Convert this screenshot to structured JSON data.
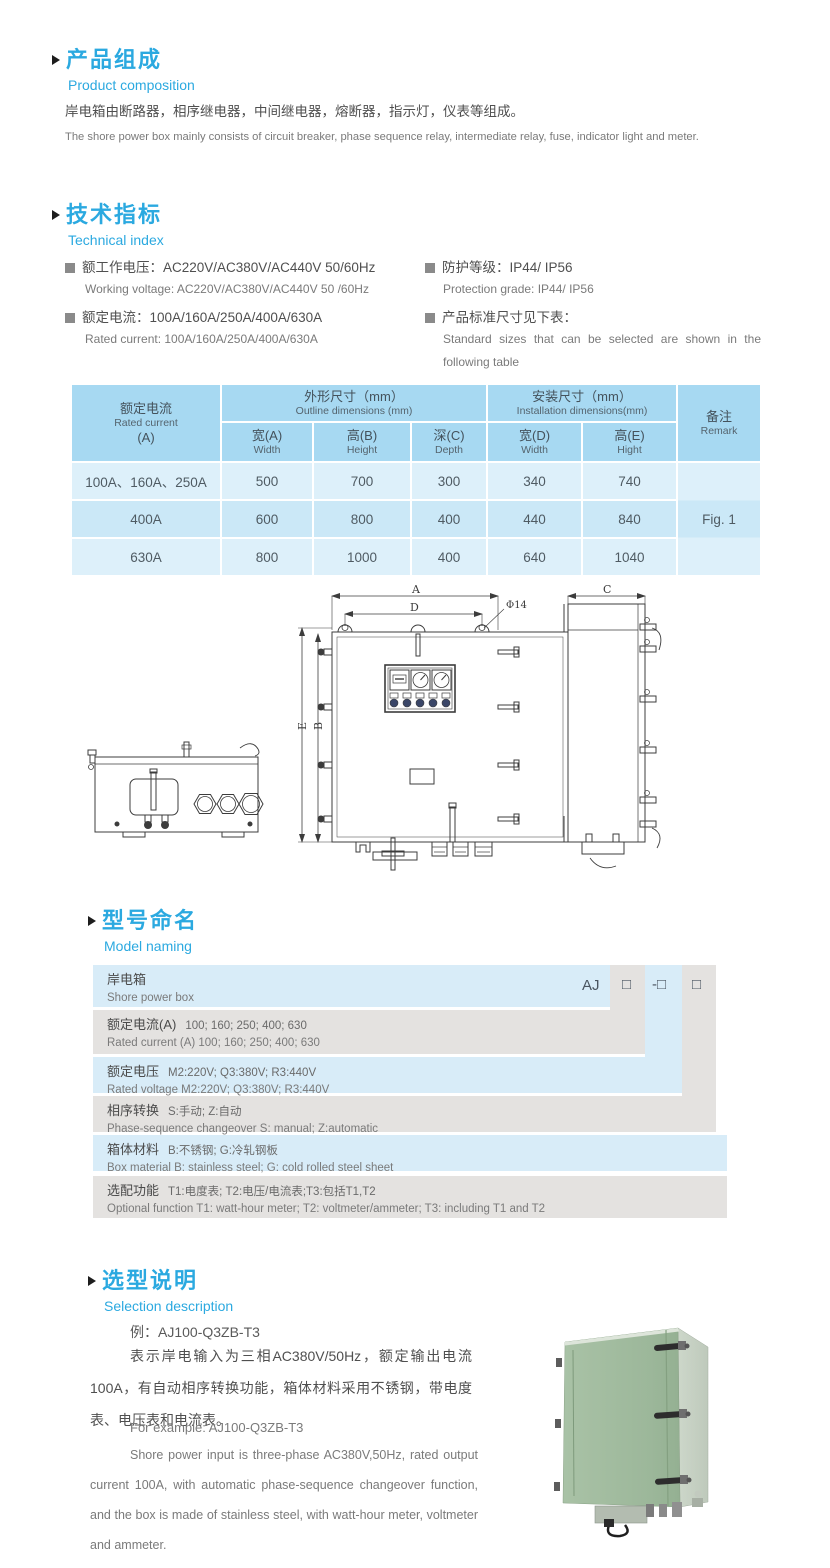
{
  "accent_color": "#2ba9e0",
  "product_composition": {
    "title_cn": "产品组成",
    "title_en": "Product  composition",
    "body_cn": "岸电箱由断路器，相序继电器，中间继电器，熔断器，指示灯，仪表等组成。",
    "body_en": "The shore power box mainly consists of circuit breaker, phase sequence relay, intermediate relay, fuse, indicator light and meter."
  },
  "technical_index": {
    "title_cn": "技术指标",
    "title_en": "Technical index",
    "specs_left": [
      {
        "cn": "额工作电压：AC220V/AC380V/AC440V  50/60Hz",
        "en": "Working voltage: AC220V/AC380V/AC440V 50 /60Hz"
      },
      {
        "cn": "额定电流：100A/160A/250A/400A/630A",
        "en": "Rated current: 100A/160A/250A/400A/630A"
      }
    ],
    "specs_right": [
      {
        "cn": "防护等级：IP44/ IP56",
        "en": "Protection grade: IP44/ IP56"
      },
      {
        "cn": "产品标准尺寸见下表：",
        "en": "Standard sizes that can be selected are shown in the following table"
      }
    ]
  },
  "dimensions_table": {
    "header": {
      "current_cn": "额定电流",
      "current_en": "Rated current",
      "current_unit": "(A)",
      "outline_cn": "外形尺寸（mm）",
      "outline_en": "Outline dimensions (mm)",
      "install_cn": "安装尺寸（mm）",
      "install_en": "Installation dimensions(mm)",
      "remark_cn": "备注",
      "remark_en": "Remark",
      "sub": [
        {
          "cn": "宽(A)",
          "en": "Width"
        },
        {
          "cn": "高(B)",
          "en": "Height"
        },
        {
          "cn": "深(C)",
          "en": "Depth"
        },
        {
          "cn": "宽(D)",
          "en": "Width"
        },
        {
          "cn": "高(E)",
          "en": "Hight"
        }
      ]
    },
    "rows": [
      {
        "current": "100A、160A、250A",
        "a": "500",
        "b": "700",
        "c": "300",
        "d": "340",
        "e": "740"
      },
      {
        "current": "400A",
        "a": "600",
        "b": "800",
        "c": "400",
        "d": "440",
        "e": "840"
      },
      {
        "current": "630A",
        "a": "800",
        "b": "1000",
        "c": "400",
        "d": "640",
        "e": "1040"
      }
    ],
    "remark_value": "Fig. 1"
  },
  "figure": {
    "labels": {
      "a": "A",
      "d": "D",
      "hole": "Φ14",
      "e": "E",
      "b": "B",
      "c": "C"
    }
  },
  "model_naming": {
    "title_cn": "型号命名",
    "title_en": "Model naming",
    "code": {
      "prefix": "AJ",
      "slot1": "□",
      "slot2": "-□",
      "slot3": "□"
    },
    "rows": [
      {
        "cn_label": "岸电箱",
        "en": "Shore power box"
      },
      {
        "cn_label": "额定电流(A)",
        "cn_value": "100; 160; 250; 400; 630",
        "en": "Rated current (A) 100; 160; 250; 400; 630"
      },
      {
        "cn_label": "额定电压",
        "cn_value": "M2:220V;  Q3:380V;  R3:440V",
        "en": "Rated voltage  M2:220V;  Q3:380V;  R3:440V"
      },
      {
        "cn_label": "相序转换",
        "cn_value": "S:手动; Z:自动",
        "en": "Phase-sequence changeover  S: manual;  Z:automatic"
      },
      {
        "cn_label": "箱体材料",
        "cn_value": "B:不锈钢;  G:冷轧钢板",
        "en": "Box material   B: stainless steel; G: cold rolled steel sheet"
      },
      {
        "cn_label": "选配功能",
        "cn_value": "T1:电度表;  T2:电压/电流表;T3:包括T1,T2",
        "en": "Optional function  T1: watt-hour meter; T2: voltmeter/ammeter; T3: including T1 and T2"
      }
    ]
  },
  "selection": {
    "title_cn": "选型说明",
    "title_en": "Selection description",
    "example_cn": "例：AJ100-Q3ZB-T3",
    "body_cn": "表示岸电输入为三相AC380V/50Hz，额定输出电流100A，有自动相序转换功能，箱体材料采用不锈钢，带电度表、电压表和电流表。",
    "example_en": "For example: AJ100-Q3ZB-T3",
    "body_en": "Shore power input is three-phase AC380V,50Hz, rated output current 100A, with automatic phase-sequence changeover function, and the box is made of stainless steel, with watt-hour meter, voltmeter and ammeter."
  }
}
